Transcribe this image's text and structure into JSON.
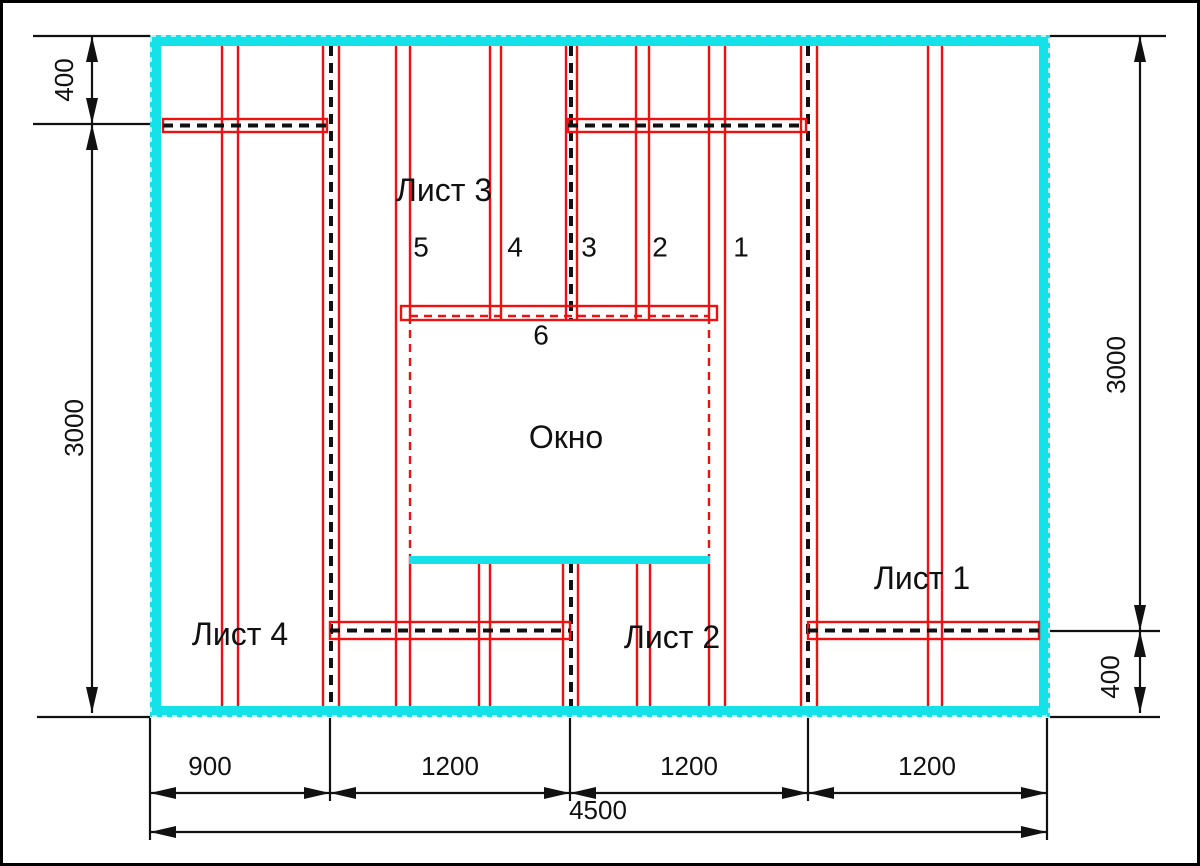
{
  "page": {
    "background": "#ffffff",
    "border_color": "#000000"
  },
  "colors": {
    "wall": "#14E1E8",
    "wall_edge_dash": "#BDF0F4",
    "stud": "#EE1111",
    "joint_dash": "#111111",
    "dimension": "#111111",
    "text": "#111111"
  },
  "labels": {
    "sheet_1": "Лист 1",
    "sheet_2": "Лист 2",
    "sheet_3": "Лист 3",
    "sheet_4": "Лист 4",
    "window": "Окно"
  },
  "stud_numbers": [
    {
      "text": "5",
      "x": 421,
      "y": 247
    },
    {
      "text": "4",
      "x": 515,
      "y": 247
    },
    {
      "text": "3",
      "x": 589,
      "y": 247
    },
    {
      "text": "2",
      "x": 660,
      "y": 247
    },
    {
      "text": "1",
      "x": 741,
      "y": 247
    },
    {
      "text": "6",
      "x": 541,
      "y": 335
    }
  ],
  "dimensions": {
    "top_left": "400",
    "left": "3000",
    "right": "3000",
    "bottom_right": "400",
    "bottom_segments": [
      "900",
      "1200",
      "1200",
      "1200"
    ],
    "total_width": "4500"
  },
  "geometry": {
    "canvas": {
      "w": 1200,
      "h": 866
    },
    "wall": {
      "x1": 150,
      "y1": 35,
      "x2": 1050,
      "y2": 717,
      "t": 11
    },
    "sill": {
      "x": 409,
      "y": 556,
      "w": 301,
      "h": 8
    },
    "window": {
      "x1": 410,
      "y1": 316,
      "x2": 709,
      "y2": 556
    },
    "header": {
      "x1": 401,
      "y1": 306,
      "x2": 717,
      "y2": 320
    },
    "strips": [
      {
        "x1": 163,
        "x2": 327,
        "y1": 119,
        "y2": 132
      },
      {
        "x1": 568,
        "x2": 806,
        "y1": 119,
        "y2": 132
      },
      {
        "x1": 330,
        "x2": 570,
        "y1": 622,
        "y2": 639
      },
      {
        "x1": 808,
        "x2": 1039,
        "y1": 622,
        "y2": 639
      }
    ],
    "studs": [
      {
        "x": 222,
        "segs": [
          [
            46,
            706
          ]
        ]
      },
      {
        "x": 238,
        "segs": [
          [
            46,
            706
          ]
        ]
      },
      {
        "x": 323,
        "segs": [
          [
            46,
            706
          ]
        ]
      },
      {
        "x": 339,
        "segs": [
          [
            46,
            706
          ]
        ]
      },
      {
        "x": 396,
        "segs": [
          [
            46,
            706
          ]
        ]
      },
      {
        "x": 410,
        "segs": [
          [
            46,
            316
          ],
          [
            556,
            706
          ]
        ]
      },
      {
        "x": 490,
        "segs": [
          [
            46,
            320
          ]
        ]
      },
      {
        "x": 501,
        "segs": [
          [
            46,
            320
          ]
        ]
      },
      {
        "x": 566,
        "segs": [
          [
            46,
            320
          ]
        ]
      },
      {
        "x": 577,
        "segs": [
          [
            46,
            320
          ]
        ]
      },
      {
        "x": 636,
        "segs": [
          [
            46,
            320
          ]
        ]
      },
      {
        "x": 649,
        "segs": [
          [
            46,
            320
          ]
        ]
      },
      {
        "x": 479,
        "segs": [
          [
            563,
            706
          ]
        ]
      },
      {
        "x": 490,
        "segs": [
          [
            563,
            706
          ]
        ]
      },
      {
        "x": 563,
        "segs": [
          [
            563,
            706
          ]
        ]
      },
      {
        "x": 578,
        "segs": [
          [
            563,
            706
          ]
        ]
      },
      {
        "x": 637,
        "segs": [
          [
            563,
            706
          ]
        ]
      },
      {
        "x": 650,
        "segs": [
          [
            563,
            706
          ]
        ]
      },
      {
        "x": 709,
        "segs": [
          [
            46,
            316
          ],
          [
            556,
            706
          ]
        ]
      },
      {
        "x": 725,
        "segs": [
          [
            46,
            706
          ]
        ]
      },
      {
        "x": 801,
        "segs": [
          [
            46,
            706
          ]
        ]
      },
      {
        "x": 817,
        "segs": [
          [
            46,
            706
          ]
        ]
      },
      {
        "x": 928,
        "segs": [
          [
            46,
            706
          ]
        ]
      },
      {
        "x": 942,
        "segs": [
          [
            46,
            706
          ]
        ]
      }
    ],
    "joints": [
      {
        "x": 331,
        "segs": [
          [
            46,
            706
          ]
        ]
      },
      {
        "x": 571,
        "segs": [
          [
            46,
            320
          ],
          [
            563,
            706
          ]
        ]
      },
      {
        "x": 808,
        "segs": [
          [
            46,
            706
          ]
        ]
      }
    ],
    "sheet_labels": [
      {
        "key": "sheet_3",
        "x": 444,
        "y": 190
      },
      {
        "key": "sheet_4",
        "x": 240,
        "y": 634
      },
      {
        "key": "sheet_2",
        "x": 672,
        "y": 637
      },
      {
        "key": "sheet_1",
        "x": 922,
        "y": 578
      },
      {
        "key": "window",
        "x": 566,
        "y": 437
      }
    ],
    "dims": {
      "ext_h": [
        [
          33,
          36,
          150
        ],
        [
          33,
          124,
          150
        ],
        [
          37,
          717,
          150
        ],
        [
          1050,
          36,
          1166
        ],
        [
          1050,
          631,
          1160
        ],
        [
          1050,
          717,
          1160
        ]
      ],
      "ext_v": [
        {
          "x": 150,
          "y1": 718,
          "y2": 840
        },
        {
          "x": 330,
          "y1": 718,
          "y2": 801
        },
        {
          "x": 570,
          "y1": 718,
          "y2": 801
        },
        {
          "x": 808,
          "y1": 718,
          "y2": 801
        },
        {
          "x": 1047,
          "y1": 718,
          "y2": 840
        }
      ],
      "left": {
        "x": 92,
        "spans": [
          {
            "y1": 36,
            "y2": 124,
            "label": "400",
            "tx": 64,
            "ty": 80
          },
          {
            "y1": 124,
            "y2": 713,
            "label": "3000",
            "tx": 74,
            "ty": 428
          }
        ]
      },
      "right": {
        "x": 1140,
        "spans": [
          {
            "y1": 36,
            "y2": 631,
            "label": "3000",
            "tx": 1116,
            "ty": 365
          },
          {
            "y1": 631,
            "y2": 713,
            "label": "400",
            "tx": 1110,
            "ty": 677
          }
        ]
      },
      "bottom": {
        "y": 793,
        "ty": 766,
        "spans": [
          {
            "x1": 150,
            "x2": 330,
            "label": "900",
            "tx": 210
          },
          {
            "x1": 330,
            "x2": 570,
            "label": "1200",
            "tx": 450
          },
          {
            "x1": 570,
            "x2": 808,
            "label": "1200",
            "tx": 689
          },
          {
            "x1": 808,
            "x2": 1047,
            "label": "1200",
            "tx": 927
          }
        ]
      },
      "total": {
        "y": 832,
        "x1": 150,
        "x2": 1047,
        "label": "4500",
        "tx": 598,
        "ty": 810
      }
    }
  }
}
